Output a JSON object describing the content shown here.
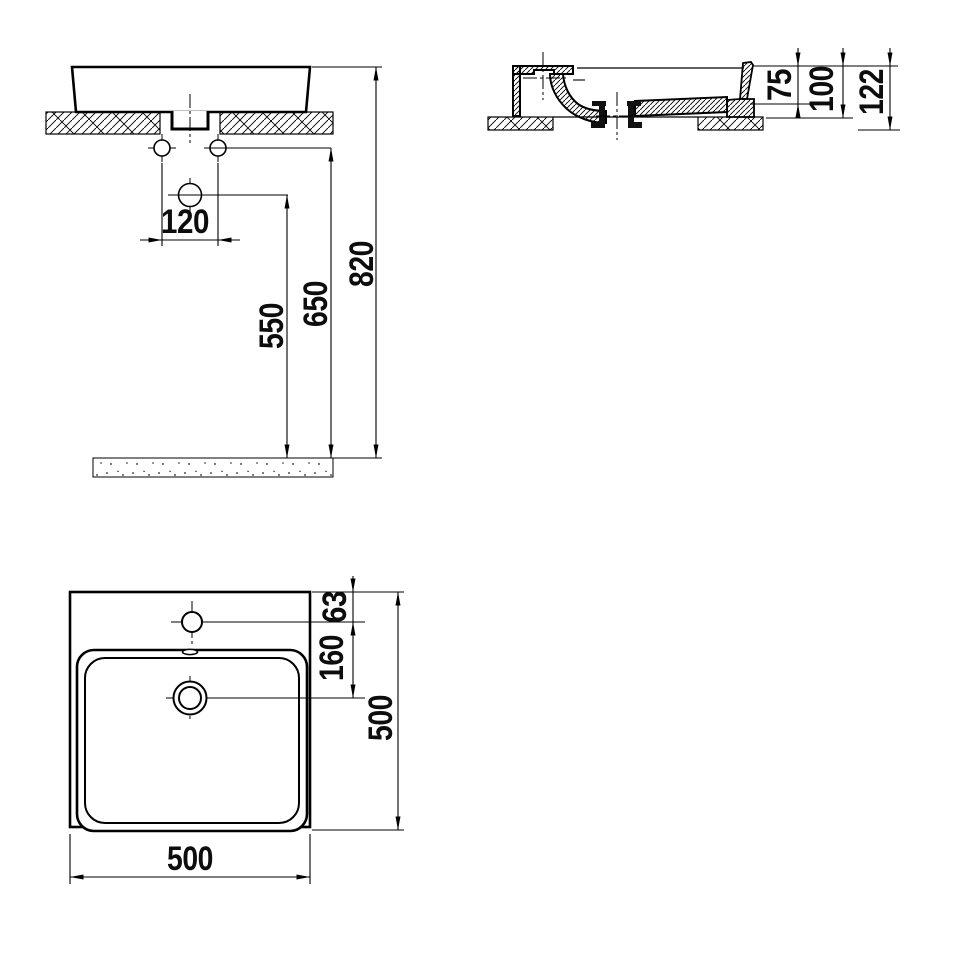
{
  "drawing": {
    "type": "washbasin-technical-drawing",
    "colors": {
      "line": "#000000",
      "background": "#ffffff",
      "text": "#0d0d0d"
    },
    "front": {
      "hole_spacing": "120",
      "drain_height": "550",
      "holes_height": "650",
      "rim_height": "820"
    },
    "section": {
      "basin_depth": "75",
      "body_height": "100",
      "overall_height": "122"
    },
    "plan": {
      "tap_offset": "63",
      "tap_to_drain": "160",
      "width": "500",
      "depth": "500"
    }
  }
}
